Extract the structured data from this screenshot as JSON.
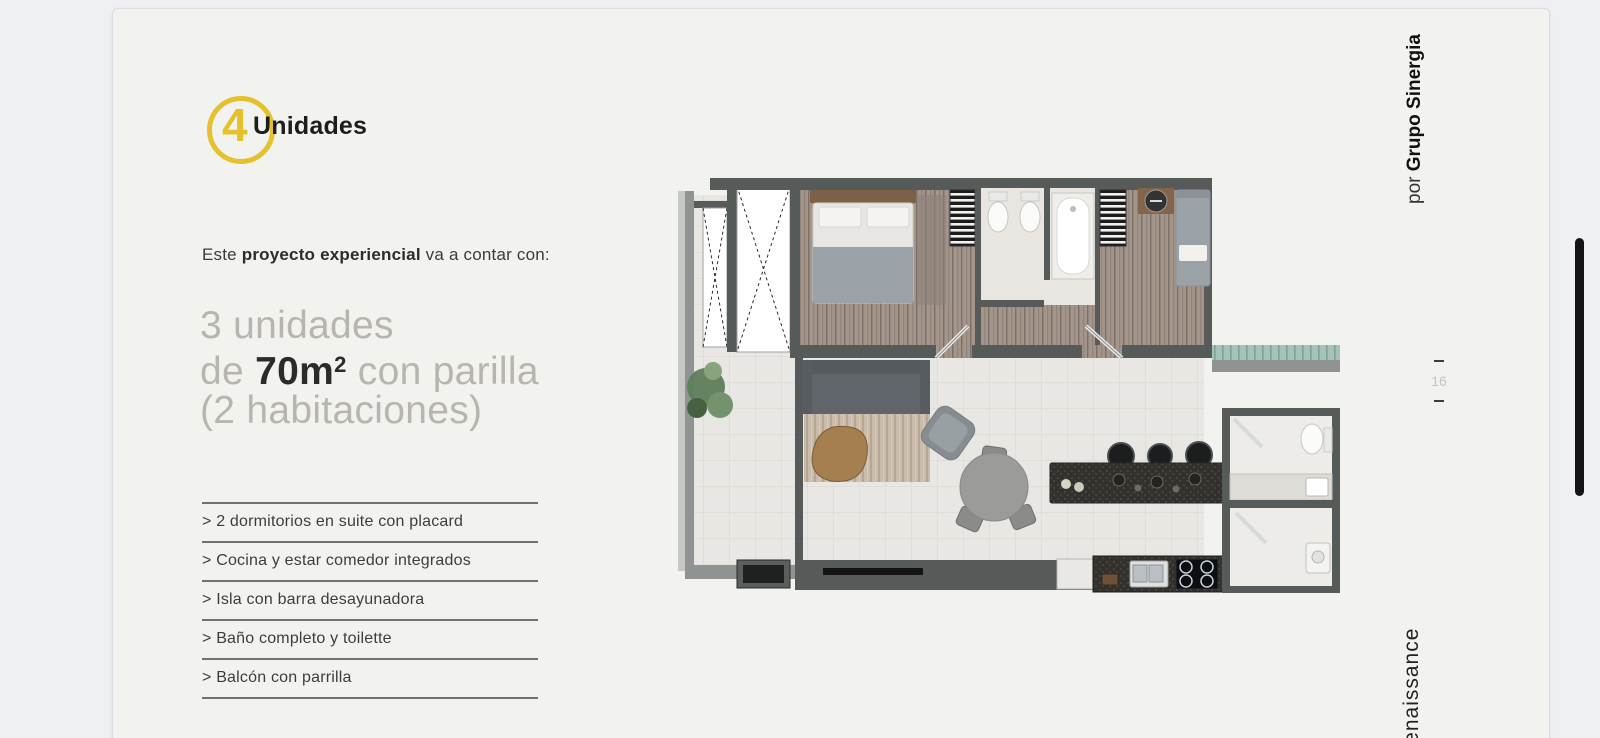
{
  "page": {
    "logo": {
      "number": "4",
      "label": "Unidades"
    },
    "intro": {
      "prefix": "Este ",
      "emphasis": "proyecto experiencial",
      "suffix": " va a contar con:"
    },
    "headline": {
      "line1": "3 unidades",
      "line2_pre": "de ",
      "line2_bold": "70m",
      "line2_sup": "2",
      "line2_post": " con parilla",
      "line3": "(2 habitaciones)"
    },
    "features": [
      "> 2 dormitorios en suite con placard",
      "> Cocina y estar comedor integrados",
      "> Isla con barra desayunadora",
      "> Baño completo y toilette",
      "> Balcón con parrilla"
    ],
    "byline": {
      "prefix": "por ",
      "brand": "Grupo Sinergia"
    },
    "page_indicator": {
      "number": "16"
    },
    "footer_brand": "Renaissance"
  },
  "palette": {
    "accent_yellow": "#E4C22E",
    "canvas_bg": "#EFF0F4",
    "page_bg": "#F2F2EF",
    "headline_gray": "#B8B5B1",
    "text_dark": "#2B2B2B",
    "divider_gray": "#717171",
    "wall_gray": "#565B5A",
    "scrollbar_black": "#141418"
  }
}
